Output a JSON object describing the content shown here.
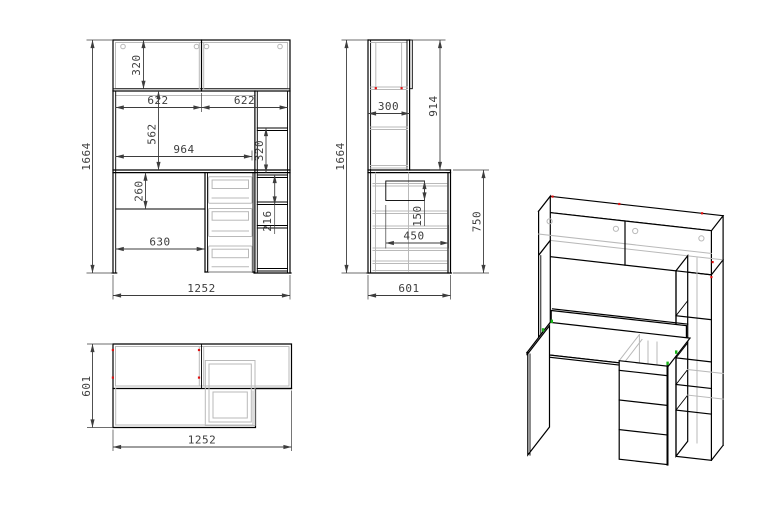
{
  "drawing": {
    "front_view": {
      "dims": {
        "total_height": "1664",
        "cabinet_height": "320",
        "door_left_width": "622",
        "door_right_width": "622",
        "niche_height": "562",
        "niche_width": "964",
        "shelf_spacing_upper": "320",
        "under_desk_height": "260",
        "shelf_spacing_lower": "216",
        "left_opening_width": "630",
        "total_width": "1252"
      }
    },
    "side_view": {
      "dims": {
        "total_height": "1664",
        "top_depth": "300",
        "upper_section_height": "914",
        "drawer_height": "150",
        "drawer_depth": "450",
        "desk_height": "750",
        "total_depth": "601"
      }
    },
    "top_view": {
      "dims": {
        "total_depth": "601",
        "total_width": "1252"
      }
    },
    "colors": {
      "outline": "#000000",
      "hidden": "#b9b9b9",
      "dimension": "#3d3d3d",
      "accent_red": "#e01010",
      "accent_green": "#18b418",
      "background": "#ffffff"
    }
  }
}
